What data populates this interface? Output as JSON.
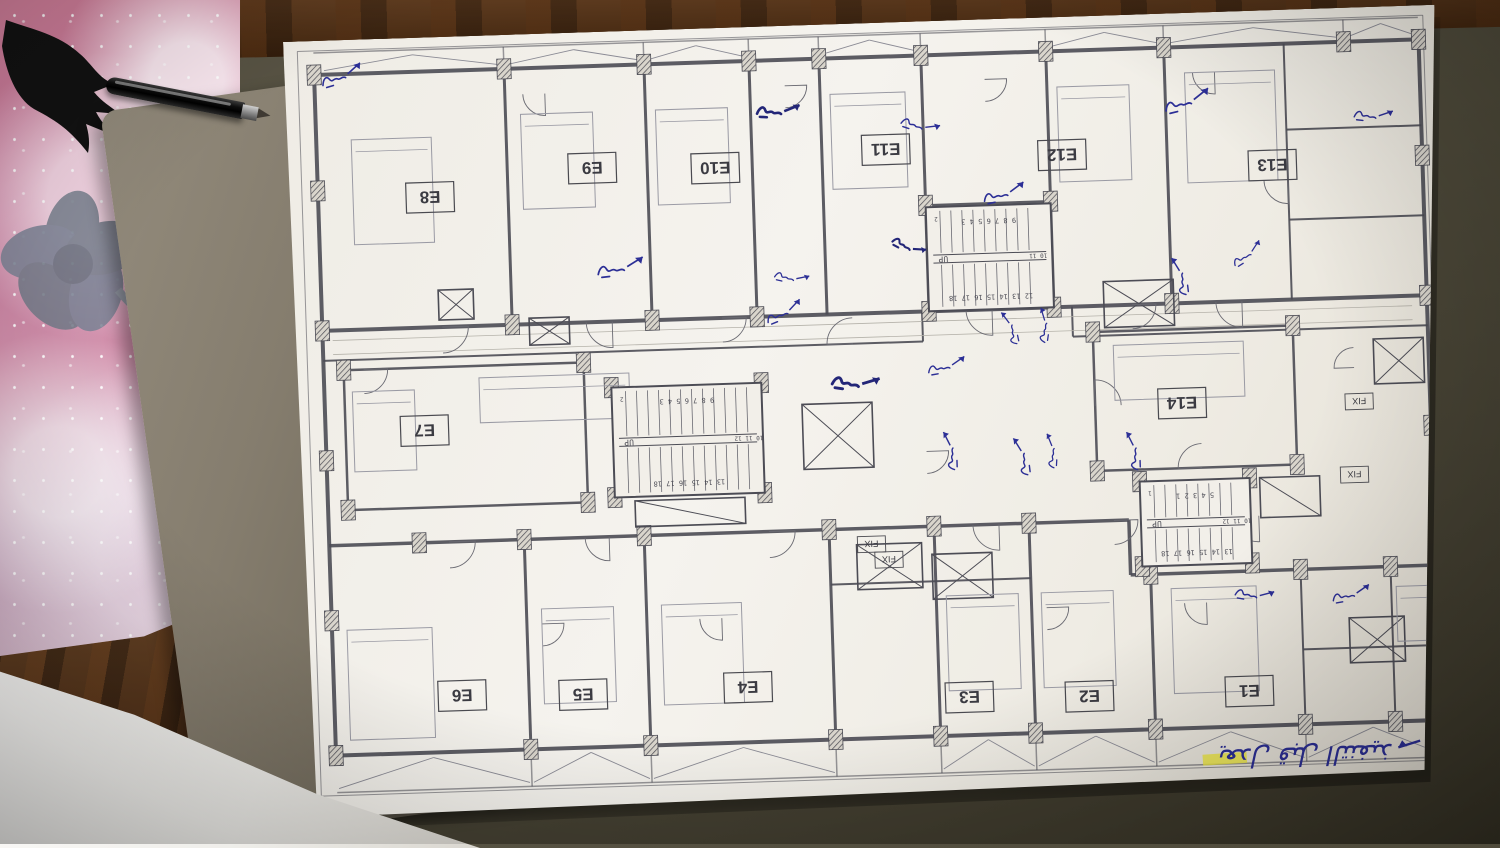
{
  "scene": {
    "mat_color": "#4e4a3a",
    "wood_color": "#54341a",
    "pad_pink": "#d27f9b",
    "book_color": "#857d6e",
    "paper_color": "#f5f3ee",
    "ink_color": "#2c2f96",
    "line_color": "#4c4c55",
    "highlight_color": "#f0ea3e"
  },
  "plan": {
    "units": [
      {
        "id": "E8",
        "label": "E8",
        "x": 142,
        "y": 160
      },
      {
        "id": "E9",
        "label": "E9",
        "x": 305,
        "y": 136
      },
      {
        "id": "E10",
        "label": "E10",
        "x": 428,
        "y": 140
      },
      {
        "id": "E11",
        "label": "E11",
        "x": 599,
        "y": 127
      },
      {
        "id": "E12",
        "label": "E12",
        "x": 775,
        "y": 138
      },
      {
        "id": "E13",
        "label": "E13",
        "x": 985,
        "y": 155
      },
      {
        "id": "E7",
        "label": "E7",
        "x": 129,
        "y": 393
      },
      {
        "id": "E14",
        "label": "E14",
        "x": 887,
        "y": 390
      },
      {
        "id": "E6",
        "label": "E6",
        "x": 158,
        "y": 659
      },
      {
        "id": "E5",
        "label": "E5",
        "x": 279,
        "y": 662
      },
      {
        "id": "E4",
        "label": "E4",
        "x": 444,
        "y": 660
      },
      {
        "id": "E3",
        "label": "E3",
        "x": 665,
        "y": 677
      },
      {
        "id": "E2",
        "label": "E2",
        "x": 785,
        "y": 680
      },
      {
        "id": "E1",
        "label": "E1",
        "x": 945,
        "y": 680
      }
    ],
    "fix_labels": [
      {
        "label": "FIX",
        "x": 1064,
        "y": 394
      },
      {
        "label": "FIX",
        "x": 1057,
        "y": 467
      },
      {
        "label": "FIX",
        "x": 572,
        "y": 521
      },
      {
        "label": "FIX",
        "x": 589,
        "y": 537
      }
    ],
    "stairs": [
      {
        "x": 637,
        "y": 186,
        "w": 125,
        "h": 104,
        "top": "9 8 7 6 5 4 3",
        "bottom": "12 13 14 15 16 17 18",
        "side": "10 11",
        "up": "UP",
        "extra": "2"
      },
      {
        "x": 317,
        "y": 356,
        "w": 150,
        "h": 110,
        "top": "9 8 7 6 5 4 3",
        "bottom": "13 14 15 16 17 18",
        "side": "10 11 12",
        "up": "UP",
        "extra": "2"
      },
      {
        "x": 842,
        "y": 467,
        "w": 110,
        "h": 85,
        "top": "5 4 3 2 1",
        "bottom": "13 14 15 16 17 18",
        "side": "10 11 12",
        "up": "UP",
        "extra": "1"
      }
    ],
    "note": {
      "text": "يعدل قبل التنفيذ",
      "x": 1000,
      "y": 755,
      "size": 26,
      "rotate": 180
    },
    "highlight": {
      "x": 896,
      "y": 742,
      "w": 44,
      "h": 11,
      "rotate": -2
    },
    "walls": [
      [
        14,
        10,
        1140,
        10,
        1
      ],
      [
        14,
        10,
        14,
        755,
        1
      ],
      [
        1140,
        10,
        1140,
        755,
        1
      ],
      [
        14,
        755,
        1140,
        755,
        1
      ],
      [
        30,
        12,
        1135,
        12,
        1.5
      ],
      [
        30,
        752,
        1135,
        752,
        1.5
      ],
      [
        30,
        34,
        1135,
        34,
        4
      ],
      [
        30,
        290,
        1135,
        290,
        4
      ],
      [
        30,
        34,
        30,
        715,
        4
      ],
      [
        1135,
        34,
        1135,
        715,
        4
      ],
      [
        30,
        715,
        1135,
        715,
        4
      ],
      [
        30,
        320,
        630,
        320,
        2
      ],
      [
        780,
        320,
        1135,
        320,
        2
      ],
      [
        30,
        505,
        830,
        505,
        3.5
      ],
      [
        830,
        505,
        830,
        560,
        3.5
      ],
      [
        830,
        560,
        1135,
        560,
        3.5
      ],
      [
        220,
        34,
        220,
        290,
        3
      ],
      [
        360,
        34,
        360,
        290,
        3
      ],
      [
        465,
        34,
        465,
        290,
        3
      ],
      [
        535,
        34,
        535,
        290,
        3
      ],
      [
        637,
        34,
        637,
        290,
        3
      ],
      [
        762,
        34,
        762,
        290,
        3
      ],
      [
        880,
        34,
        880,
        290,
        3
      ],
      [
        637,
        184,
        762,
        184,
        2.5
      ],
      [
        225,
        505,
        225,
        715,
        3
      ],
      [
        345,
        505,
        345,
        715,
        3
      ],
      [
        530,
        505,
        530,
        715,
        3
      ],
      [
        635,
        505,
        635,
        715,
        3
      ],
      [
        730,
        505,
        730,
        715,
        3
      ],
      [
        850,
        560,
        850,
        715,
        3
      ],
      [
        1000,
        560,
        1000,
        715,
        2
      ],
      [
        1090,
        560,
        1090,
        715,
        2
      ],
      [
        1000,
        640,
        1135,
        640,
        2
      ],
      [
        1000,
        34,
        1000,
        290,
        2
      ],
      [
        1000,
        120,
        1135,
        120,
        2
      ],
      [
        1000,
        210,
        1135,
        210,
        2
      ],
      [
        50,
        330,
        290,
        330,
        2.5
      ],
      [
        50,
        330,
        50,
        470,
        2.5
      ],
      [
        290,
        330,
        290,
        470,
        2.5
      ],
      [
        50,
        470,
        290,
        470,
        2.5
      ],
      [
        800,
        316,
        1000,
        316,
        2.5
      ],
      [
        800,
        316,
        800,
        455,
        2.5
      ],
      [
        1000,
        316,
        1000,
        455,
        2.5
      ],
      [
        800,
        455,
        1000,
        455,
        2.5
      ],
      [
        630,
        290,
        630,
        320,
        2
      ],
      [
        780,
        290,
        780,
        320,
        2
      ],
      [
        530,
        560,
        730,
        560,
        2
      ],
      [
        220,
        12,
        220,
        34,
        1.5
      ],
      [
        360,
        12,
        360,
        34,
        1.5
      ],
      [
        465,
        12,
        465,
        34,
        1.5
      ],
      [
        535,
        12,
        535,
        34,
        1.5
      ],
      [
        637,
        12,
        637,
        34,
        1.5
      ],
      [
        762,
        12,
        762,
        34,
        1.5
      ],
      [
        880,
        12,
        880,
        34,
        1.5
      ],
      [
        1060,
        12,
        1060,
        34,
        1.5
      ],
      [
        225,
        715,
        225,
        752,
        1.5
      ],
      [
        345,
        715,
        345,
        752,
        1.5
      ],
      [
        530,
        715,
        530,
        752,
        1.5
      ],
      [
        635,
        715,
        635,
        752,
        1.5
      ],
      [
        730,
        715,
        730,
        752,
        1.5
      ],
      [
        850,
        715,
        850,
        752,
        1.5
      ],
      [
        1000,
        715,
        1000,
        752,
        1.5
      ]
    ],
    "corridor_lines": [
      [
        40,
        300,
        1120,
        300
      ],
      [
        40,
        314,
        1120,
        314
      ]
    ],
    "bays_top": [
      [
        40,
        218
      ],
      [
        222,
        358
      ],
      [
        362,
        463
      ],
      [
        537,
        635
      ],
      [
        764,
        878
      ],
      [
        882,
        1058
      ],
      [
        1062,
        1133
      ]
    ],
    "bays_bottom": [
      [
        32,
        223
      ],
      [
        227,
        343
      ],
      [
        347,
        528
      ],
      [
        637,
        728
      ],
      [
        732,
        848
      ],
      [
        852,
        998
      ],
      [
        1002,
        1133
      ]
    ],
    "band_top": [
      14,
      32
    ],
    "band_bottom": [
      717,
      750
    ],
    "hatches": [
      [
        30,
        34
      ],
      [
        220,
        34
      ],
      [
        360,
        34
      ],
      [
        465,
        34
      ],
      [
        535,
        34
      ],
      [
        637,
        34
      ],
      [
        762,
        34
      ],
      [
        880,
        34
      ],
      [
        1060,
        34
      ],
      [
        1135,
        34
      ],
      [
        30,
        290
      ],
      [
        220,
        290
      ],
      [
        360,
        290
      ],
      [
        465,
        290
      ],
      [
        637,
        290
      ],
      [
        762,
        290
      ],
      [
        880,
        290
      ],
      [
        1135,
        290
      ],
      [
        120,
        505
      ],
      [
        225,
        505
      ],
      [
        345,
        505
      ],
      [
        530,
        505
      ],
      [
        635,
        505
      ],
      [
        730,
        505
      ],
      [
        850,
        560
      ],
      [
        1000,
        560
      ],
      [
        1090,
        560
      ],
      [
        30,
        715
      ],
      [
        225,
        715
      ],
      [
        345,
        715
      ],
      [
        530,
        715
      ],
      [
        635,
        715
      ],
      [
        730,
        715
      ],
      [
        850,
        715
      ],
      [
        1000,
        715
      ],
      [
        1090,
        715
      ],
      [
        1135,
        715
      ],
      [
        30,
        150
      ],
      [
        30,
        420
      ],
      [
        30,
        580
      ],
      [
        1135,
        150
      ],
      [
        1135,
        420
      ],
      [
        1135,
        580
      ],
      [
        317,
        356
      ],
      [
        467,
        356
      ],
      [
        317,
        466
      ],
      [
        467,
        466
      ],
      [
        637,
        184
      ],
      [
        762,
        184
      ],
      [
        842,
        467
      ],
      [
        952,
        467
      ],
      [
        842,
        552
      ],
      [
        952,
        552
      ],
      [
        800,
        316
      ],
      [
        1000,
        316
      ],
      [
        800,
        455
      ],
      [
        1000,
        455
      ],
      [
        50,
        330
      ],
      [
        290,
        330
      ],
      [
        50,
        470
      ],
      [
        290,
        470
      ]
    ],
    "xboxes": [
      [
        507,
        379,
        70,
        65,
        2
      ],
      [
        812,
        266,
        70,
        46,
        2
      ],
      [
        147,
        253,
        35,
        30,
        2
      ],
      [
        237,
        284,
        40,
        27,
        2
      ],
      [
        557,
        521,
        65,
        45,
        2
      ],
      [
        632,
        533,
        60,
        45,
        2
      ],
      [
        1047,
        610,
        55,
        45,
        2
      ],
      [
        1080,
        332,
        50,
        45,
        2
      ],
      [
        337,
        470,
        110,
        26,
        1
      ],
      [
        962,
        467,
        60,
        40,
        1
      ]
    ],
    "arcs": [
      [
        150,
        290,
        26,
        0
      ],
      [
        320,
        290,
        26,
        90
      ],
      [
        430,
        290,
        24,
        0
      ],
      [
        560,
        320,
        26,
        180
      ],
      [
        700,
        290,
        26,
        90
      ],
      [
        840,
        290,
        24,
        0
      ],
      [
        950,
        290,
        26,
        90
      ],
      [
        150,
        505,
        26,
        0
      ],
      [
        310,
        505,
        24,
        90
      ],
      [
        470,
        505,
        26,
        0
      ],
      [
        700,
        505,
        26,
        90
      ],
      [
        815,
        505,
        24,
        0
      ],
      [
        960,
        505,
        26,
        90
      ],
      [
        70,
        330,
        24,
        0
      ],
      [
        800,
        390,
        26,
        270
      ],
      [
        905,
        455,
        24,
        180
      ],
      [
        345,
        440,
        22,
        90
      ],
      [
        630,
        430,
        22,
        0
      ],
      [
        240,
        590,
        22,
        0
      ],
      [
        420,
        590,
        22,
        90
      ],
      [
        745,
        590,
        22,
        0
      ],
      [
        905,
        590,
        22,
        90
      ],
      [
        1000,
        170,
        24,
        90
      ],
      [
        1060,
        360,
        20,
        180
      ],
      [
        500,
        60,
        22,
        0
      ],
      [
        260,
        60,
        22,
        90
      ],
      [
        700,
        60,
        22,
        0
      ],
      [
        930,
        60,
        22,
        90
      ]
    ],
    "furniture": [
      [
        65,
        100,
        80,
        105
      ],
      [
        235,
        80,
        72,
        95
      ],
      [
        370,
        80,
        72,
        95
      ],
      [
        545,
        70,
        75,
        95
      ],
      [
        772,
        70,
        72,
        95
      ],
      [
        900,
        60,
        90,
        110
      ],
      [
        185,
        342,
        150,
        45
      ],
      [
        58,
        352,
        62,
        80
      ],
      [
        820,
        330,
        130,
        55
      ],
      [
        45,
        590,
        85,
        110
      ],
      [
        240,
        575,
        72,
        95
      ],
      [
        360,
        575,
        80,
        100
      ],
      [
        645,
        575,
        72,
        95
      ],
      [
        740,
        575,
        72,
        95
      ],
      [
        870,
        575,
        85,
        105
      ],
      [
        1095,
        580,
        38,
        55
      ]
    ],
    "annotations": [
      [
        37,
        39,
        -15,
        1,
        0
      ],
      [
        472,
        81,
        5,
        1,
        1
      ],
      [
        617,
        96,
        20,
        0.9,
        0
      ],
      [
        695,
        176,
        -10,
        1,
        0
      ],
      [
        605,
        215,
        30,
        0.8,
        1
      ],
      [
        879,
        91,
        -12,
        1.1,
        0
      ],
      [
        1069,
        104,
        8,
        0.9,
        0
      ],
      [
        307,
        236,
        -5,
        1.1,
        0
      ],
      [
        485,
        246,
        15,
        0.8,
        0
      ],
      [
        474,
        291,
        -20,
        0.9,
        0
      ],
      [
        539,
        353,
        10,
        1.1,
        1
      ],
      [
        634,
        346,
        -8,
        0.9,
        0
      ],
      [
        652,
        449,
        -90,
        0.9,
        0
      ],
      [
        719,
        326,
        -100,
        0.8,
        0
      ],
      [
        747,
        324,
        -80,
        0.8,
        0
      ],
      [
        725,
        457,
        -95,
        0.9,
        0
      ],
      [
        752,
        450,
        -85,
        0.8,
        0
      ],
      [
        835,
        455,
        -90,
        0.9,
        0
      ],
      [
        889,
        282,
        -95,
        0.9,
        0
      ],
      [
        942,
        250,
        -30,
        0.8,
        0
      ],
      [
        935,
        578,
        12,
        0.9,
        0
      ],
      [
        1031,
        587,
        -8,
        0.9,
        0
      ]
    ]
  }
}
